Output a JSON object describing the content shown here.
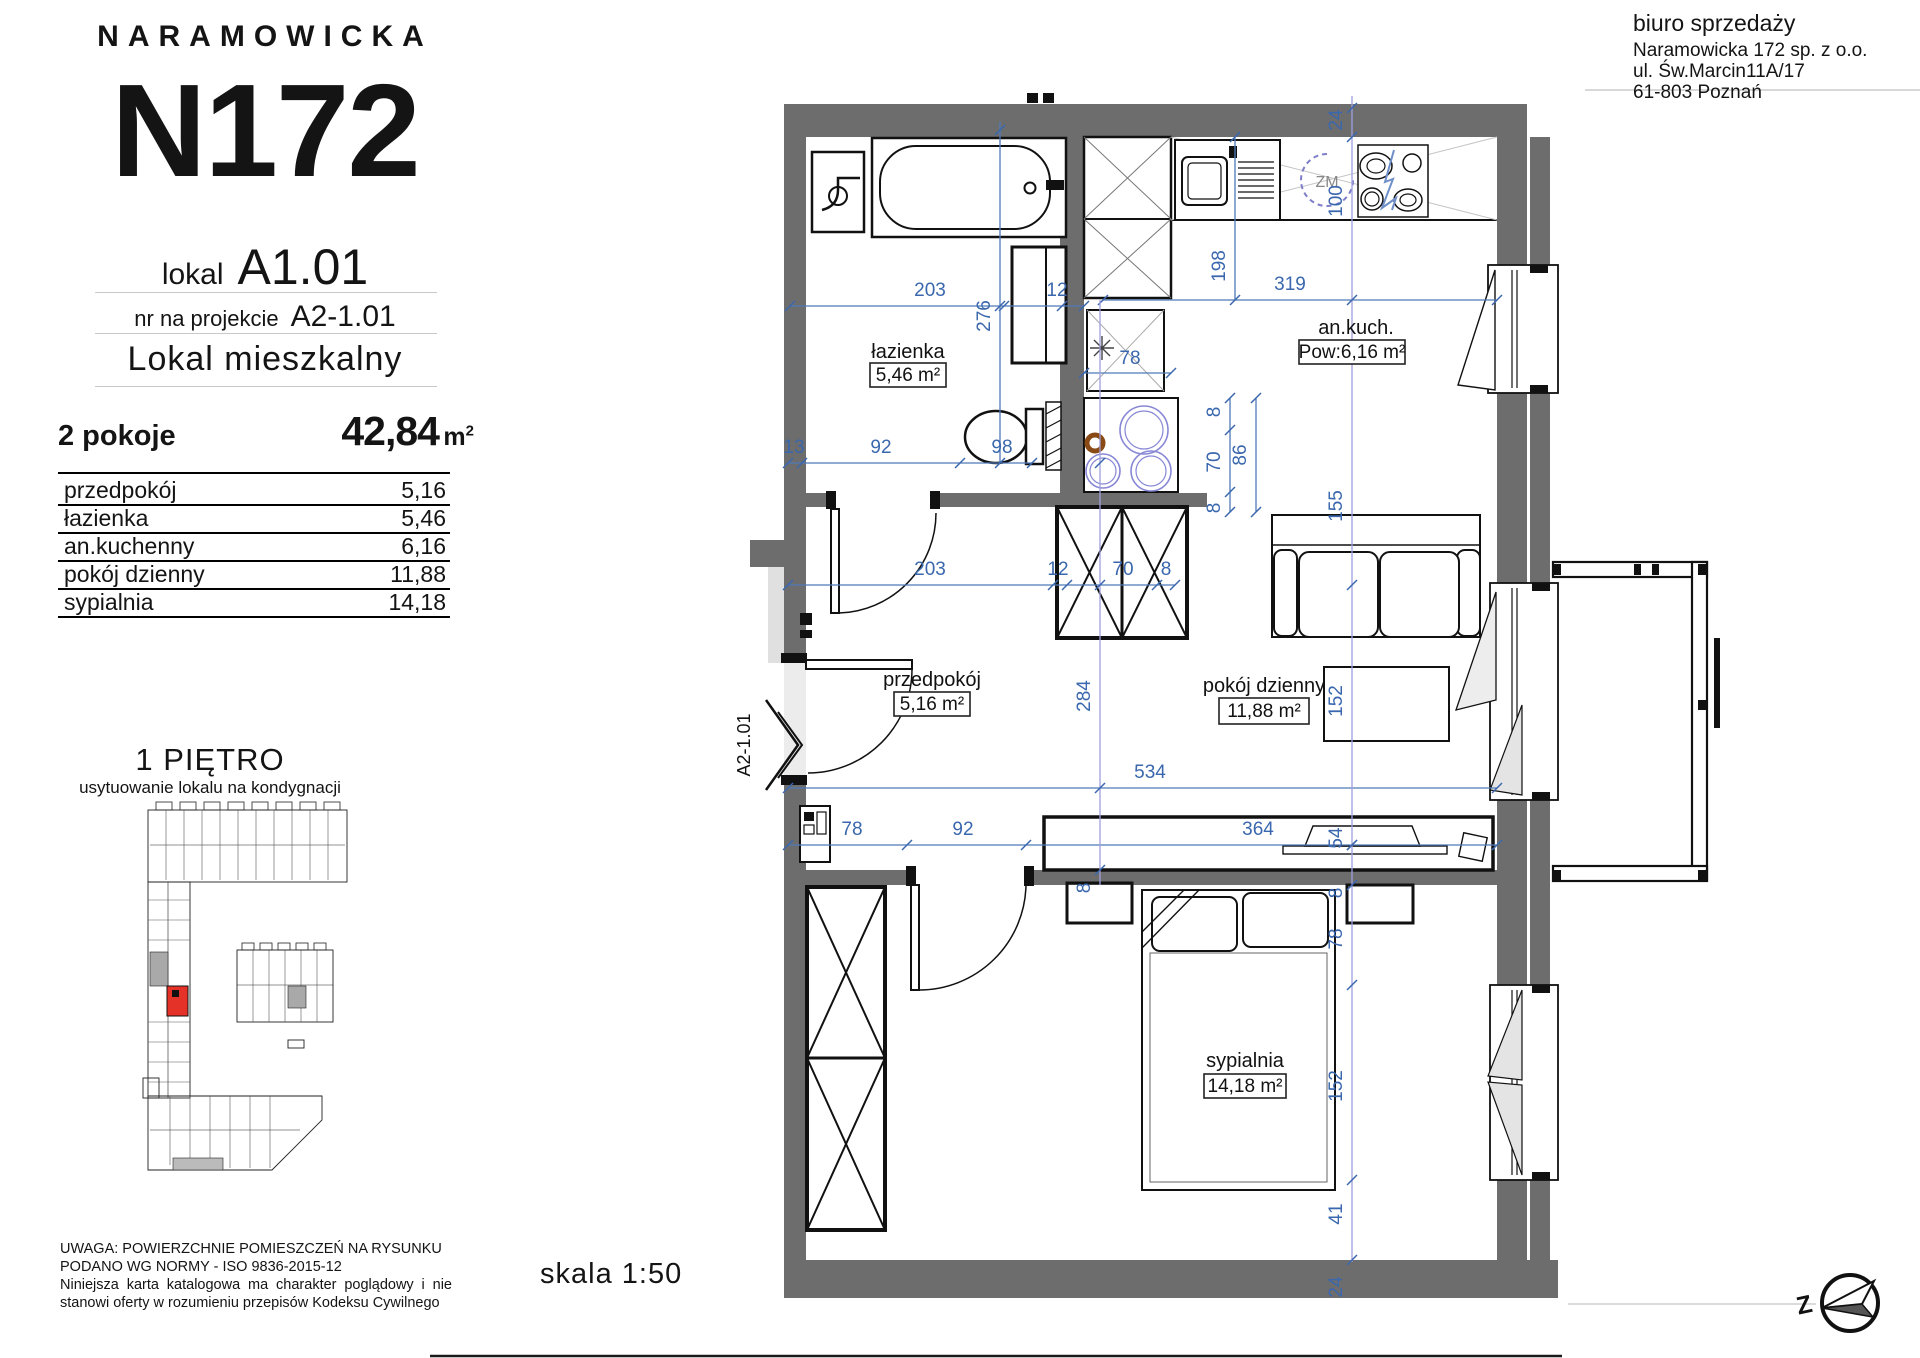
{
  "branding": {
    "estate": "NARAMOWICKA",
    "project": "N172"
  },
  "unit": {
    "lokal_label": "lokal",
    "lokal": "A1.01",
    "project_no_label": "nr na projekcie",
    "project_no": "A2-1.01",
    "type": "Lokal mieszkalny",
    "rooms_count": "2 pokoje",
    "area": "42,84",
    "area_unit_base": "m",
    "area_unit_sup": "2"
  },
  "rooms_table": [
    {
      "name": "przedpokój",
      "area": "5,16"
    },
    {
      "name": "łazienka",
      "area": "5,46"
    },
    {
      "name": "an.kuchenny",
      "area": "6,16"
    },
    {
      "name": "pokój dzienny",
      "area": "11,88"
    },
    {
      "name": "sypialnia",
      "area": "14,18"
    }
  ],
  "floor": {
    "title": "1 PIĘTRO",
    "subtitle": "usytuowanie lokalu na kondygnacji"
  },
  "disclaimer": {
    "line1": "UWAGA: POWIERZCHNIE POMIESZCZEŃ NA RYSUNKU",
    "line2": "PODANO WG NORMY - ISO 9836-2015-12",
    "body": "Niniejsza karta katalogowa ma charakter poglądowy i nie stanowi oferty w rozumieniu przepisów Kodeksu Cywilnego"
  },
  "seller": {
    "line1": "biuro sprzedaży",
    "line2": "Naramowicka 172 sp. z o.o.",
    "line3": "ul. Św.Marcin11A/17",
    "line4": "61-803 Poznań"
  },
  "scale_label": "skala 1:50",
  "plan": {
    "entrance_label": "A2-1.01",
    "dishwasher_label": "ZM",
    "compass_letter": "Z",
    "room_labels": [
      {
        "name": "łazienka",
        "area": "5,46 m²",
        "x": 908,
        "y": 358,
        "bx": 908,
        "by": 375,
        "bw": 76,
        "bh": 24
      },
      {
        "name": "an.kuch.",
        "area": "Pow:6,16 m²",
        "x": 1356,
        "y": 334,
        "bx": 1352,
        "by": 352,
        "bw": 106,
        "bh": 24
      },
      {
        "name": "przedpokój",
        "area": "5,16 m²",
        "x": 932,
        "y": 686,
        "bx": 932,
        "by": 704,
        "bw": 76,
        "bh": 24
      },
      {
        "name": "pokój dzienny",
        "area": "11,88 m²",
        "x": 1264,
        "y": 692,
        "bx": 1264,
        "by": 711,
        "bw": 90,
        "bh": 26
      },
      {
        "name": "sypialnia",
        "area": "14,18 m²",
        "x": 1245,
        "y": 1067,
        "bx": 1245,
        "by": 1086,
        "bw": 82,
        "bh": 24
      }
    ],
    "dim_lines": [
      {
        "o": "h",
        "x1": 790,
        "x2": 1084,
        "y": 306,
        "ticks": [
          790,
          1004,
          1062,
          1084
        ]
      },
      {
        "o": "h",
        "x1": 788,
        "x2": 1032,
        "y": 463,
        "ticks": [
          788,
          802,
          960,
          1032
        ]
      },
      {
        "o": "h",
        "x1": 1103,
        "x2": 1497,
        "y": 300,
        "ticks": [
          1103,
          1497
        ]
      },
      {
        "o": "h",
        "x1": 1084,
        "x2": 1171,
        "y": 373,
        "ticks": [
          1084,
          1171
        ]
      },
      {
        "o": "h",
        "x1": 788,
        "x2": 1175,
        "y": 585,
        "ticks": [
          788,
          1053,
          1067,
          1157,
          1175
        ]
      },
      {
        "o": "h",
        "x1": 788,
        "x2": 1497,
        "y": 788,
        "ticks": [
          788,
          1497
        ]
      },
      {
        "o": "h",
        "x1": 788,
        "x2": 1497,
        "y": 845,
        "ticks": [
          788,
          907,
          1026,
          1352,
          1497
        ]
      },
      {
        "o": "v",
        "x": 1000,
        "y1": 122,
        "y2": 463,
        "ticks": [
          130,
          306,
          463
        ]
      },
      {
        "o": "v",
        "x": 1235,
        "y1": 137,
        "y2": 300,
        "ticks": [
          137,
          300
        ]
      },
      {
        "o": "v",
        "x": 1230,
        "y1": 398,
        "y2": 512,
        "ticks": [
          398,
          430,
          492,
          512
        ]
      },
      {
        "o": "v",
        "x": 1256,
        "y1": 398,
        "y2": 512,
        "ticks": [
          398,
          512
        ]
      },
      {
        "o": "v",
        "x": 1352,
        "y1": 96,
        "y2": 1262,
        "light": 1,
        "ticks": [
          108,
          137,
          300,
          585,
          845,
          885,
          985,
          1180,
          1260
        ]
      },
      {
        "o": "v",
        "x": 1100,
        "y1": 300,
        "y2": 885,
        "light": 1,
        "ticks": [
          463,
          585,
          788,
          870
        ]
      }
    ],
    "dim_texts": [
      {
        "t": "203",
        "x": 930,
        "y": 296
      },
      {
        "t": "12",
        "x": 1057,
        "y": 296
      },
      {
        "t": "319",
        "x": 1290,
        "y": 290
      },
      {
        "t": "13",
        "x": 794,
        "y": 453
      },
      {
        "t": "92",
        "x": 881,
        "y": 453
      },
      {
        "t": "98",
        "x": 1002,
        "y": 453
      },
      {
        "t": "78",
        "x": 1130,
        "y": 364
      },
      {
        "t": "203",
        "x": 930,
        "y": 575
      },
      {
        "t": "12",
        "x": 1058,
        "y": 575
      },
      {
        "t": "70",
        "x": 1123,
        "y": 575
      },
      {
        "t": "8",
        "x": 1166,
        "y": 575
      },
      {
        "t": "534",
        "x": 1150,
        "y": 778
      },
      {
        "t": "78",
        "x": 852,
        "y": 835
      },
      {
        "t": "92",
        "x": 963,
        "y": 835
      },
      {
        "t": "364",
        "x": 1258,
        "y": 835
      },
      {
        "t": "276",
        "x": 990,
        "y": 316,
        "r": 1
      },
      {
        "t": "198",
        "x": 1225,
        "y": 266,
        "r": 1
      },
      {
        "t": "24",
        "x": 1342,
        "y": 120,
        "r": 1
      },
      {
        "t": "100",
        "x": 1342,
        "y": 201,
        "r": 1
      },
      {
        "t": "8",
        "x": 1220,
        "y": 412,
        "r": 1
      },
      {
        "t": "70",
        "x": 1220,
        "y": 462,
        "r": 1
      },
      {
        "t": "8",
        "x": 1220,
        "y": 508,
        "r": 1
      },
      {
        "t": "86",
        "x": 1246,
        "y": 455,
        "r": 1
      },
      {
        "t": "155",
        "x": 1342,
        "y": 506,
        "r": 1
      },
      {
        "t": "284",
        "x": 1090,
        "y": 696,
        "r": 1
      },
      {
        "t": "152",
        "x": 1342,
        "y": 701,
        "r": 1
      },
      {
        "t": "54",
        "x": 1342,
        "y": 838,
        "r": 1
      },
      {
        "t": "8",
        "x": 1342,
        "y": 893,
        "r": 1
      },
      {
        "t": "78",
        "x": 1342,
        "y": 939,
        "r": 1
      },
      {
        "t": "152",
        "x": 1342,
        "y": 1086,
        "r": 1
      },
      {
        "t": "41",
        "x": 1342,
        "y": 1214,
        "r": 1
      },
      {
        "t": "24",
        "x": 1342,
        "y": 1287,
        "r": 1
      },
      {
        "t": "8",
        "x": 1090,
        "y": 888,
        "r": 1
      }
    ]
  },
  "colors": {
    "wall": "#6d6d6d",
    "dim_blue": "#3a67ad",
    "dim_light": "#9f9fdd",
    "highlight_red": "#e53228",
    "plate_blue": "#8787d5",
    "brown": "#8a4a15"
  }
}
